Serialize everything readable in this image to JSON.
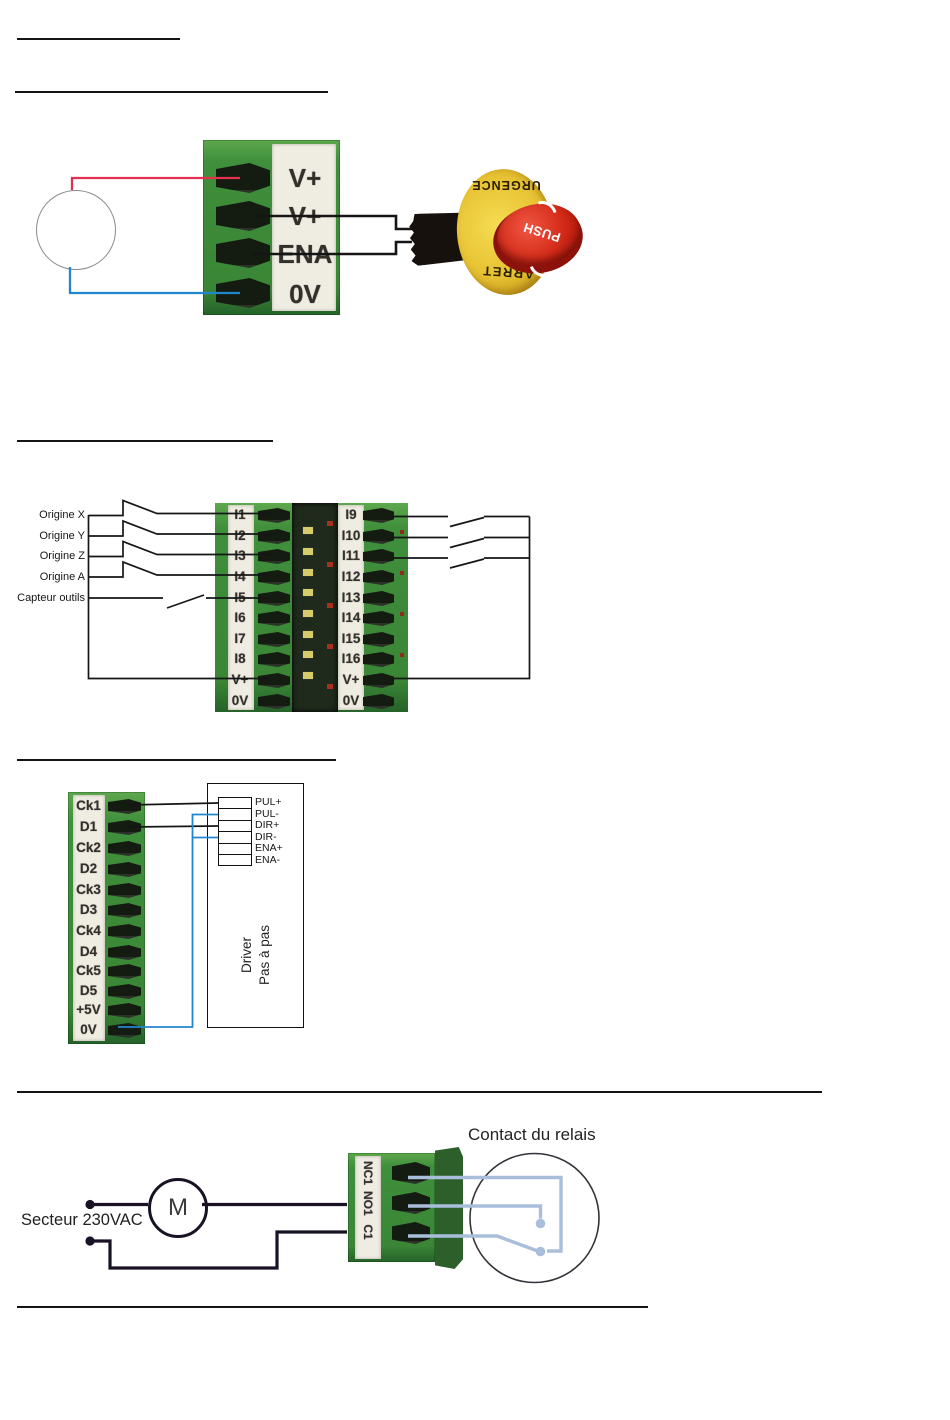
{
  "section1": {
    "terminal_labels": [
      "V+",
      "V+",
      "ENA",
      "0V"
    ],
    "estop": {
      "ring_top": "URGENCE",
      "ring_bottom": "ARRET",
      "button": "PUSH"
    }
  },
  "section2": {
    "switch_labels": [
      "Origine X",
      "Origine Y",
      "Origine Z",
      "Origine A",
      "Capteur outils"
    ],
    "left_terminal_labels": [
      "I1",
      "I2",
      "I3",
      "I4",
      "I5",
      "I6",
      "I7",
      "I8",
      "V+",
      "0V"
    ],
    "right_terminal_labels": [
      "I9",
      "I10",
      "I11",
      "I12",
      "I13",
      "I14",
      "I15",
      "I16",
      "V+",
      "0V"
    ]
  },
  "section3": {
    "terminal_labels": [
      "Ck1",
      "D1",
      "Ck2",
      "D2",
      "Ck3",
      "D3",
      "Ck4",
      "D4",
      "Ck5",
      "D5",
      "+5V",
      "0V"
    ],
    "driver_pin_labels": [
      "PUL+",
      "PUL-",
      "DIR+",
      "DIR-",
      "ENA+",
      "ENA-"
    ],
    "driver_name_line1": "Driver",
    "driver_name_line2": "Pas à pas"
  },
  "section4": {
    "mains_label": "Secteur 230VAC",
    "motor_label": "M",
    "relay_contact_title": "Contact du relais",
    "relay_terminal_labels": [
      "NC1",
      "NO1",
      "C1"
    ]
  },
  "colors": {
    "board_green": "#3f8f3c",
    "wire_red": "#e33050",
    "wire_blue": "#2286cf",
    "wire_black": "#151515",
    "relay_wire_blue": "#a9bedb",
    "estop_yellow": "#e7c233",
    "estop_red": "#d32a18"
  }
}
